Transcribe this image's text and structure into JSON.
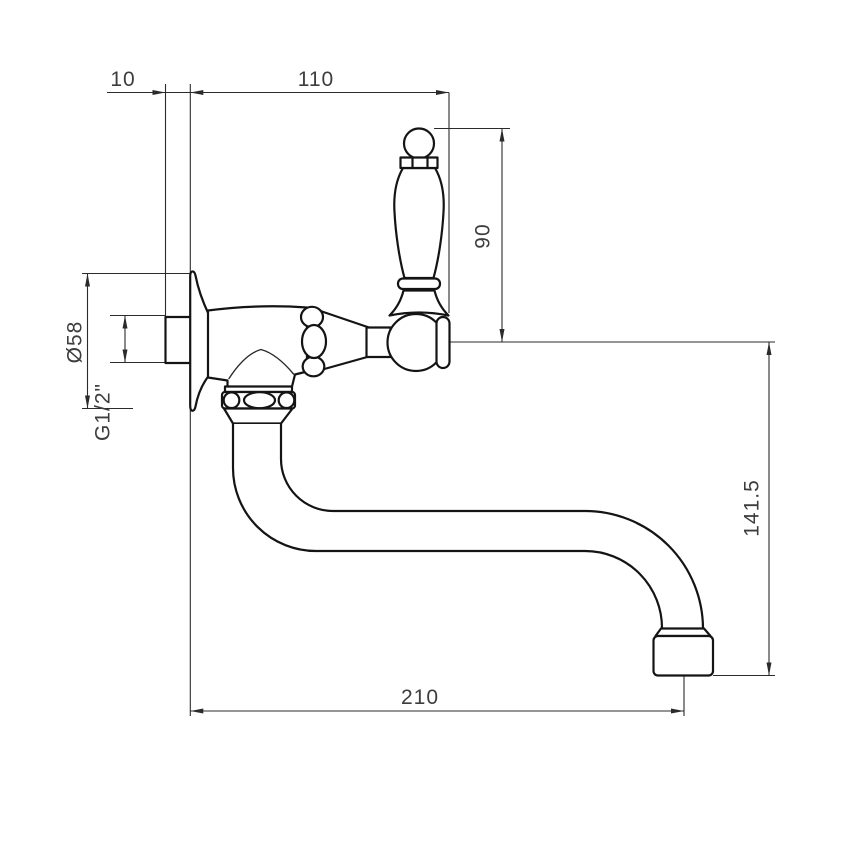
{
  "diagram": {
    "kind": "technical-drawing",
    "subject": "Wall-mounted faucet with porcelain lever handle and S-shaped swivel spout, side elevation with dimensions",
    "units": "mm",
    "background": "#ffffff",
    "line_color": "#141414",
    "dimension_line_color": "#2b2b2b",
    "text_color": "#3d3d3d"
  },
  "dims": {
    "wall_offset": "10",
    "handle_reach": "110",
    "handle_height": "90",
    "flange_diameter": "Ø58",
    "thread_size": "G1/2\"",
    "spout_drop": "141.5",
    "spout_reach": "210"
  }
}
